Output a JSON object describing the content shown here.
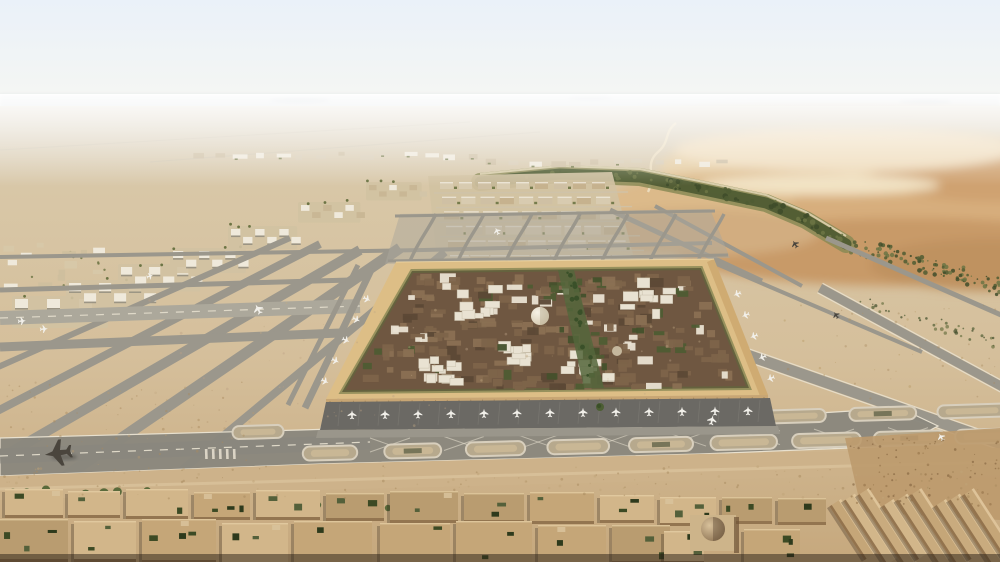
{
  "palette": {
    "skyTop": "#eaf1f9",
    "skyLow": "#f7f7f2",
    "hazeRidge": "#b7c2cb",
    "hillBlue": "#a9b5bf",
    "farDesert": "#ddd6c7",
    "sand": "#d6c19e",
    "sandLow": "#c6a87d",
    "duneLight": "#e6cfa6",
    "duneMid": "#d7ae7d",
    "duneDark": "#c2976a",
    "duneDeep": "#bf9261",
    "vegDark": "#4f5c33",
    "vegMid": "#6c7444",
    "vegLight": "#8a8a55",
    "trackLight": "#ecdfc2",
    "runway": "#9b978c",
    "runwayLight": "#aca89b",
    "apron": "#8b887e",
    "apronDark": "#6b6964",
    "marking": "#e9e2d1",
    "padFill": "#b7a98d",
    "padStroke": "#d8cfbd",
    "padInner": "#c9b795",
    "terminalFrame": "#ddbe86",
    "terminalFrameShadow": "#c69f66",
    "terminalField": "#6f5741",
    "blockBrown1": "#7d644a",
    "blockBrown2": "#8a7053",
    "blockBrown3": "#5c4936",
    "blockWhite": "#e9e2d2",
    "blockGreen": "#4e5c33",
    "domeLight": "#f6f1e5",
    "domeShade": "#c9bda2",
    "roofTan": "#c5a678",
    "roofTanLight": "#d2b68a",
    "roofShadow": "#6e5236",
    "courtGreen": "#3c4a24",
    "treeGreen": "#5a6a3b",
    "barShadow": "#8a6a45",
    "barLight": "#e0c79c",
    "planeWhite": "#f2f0ea",
    "planeDark": "#4a453d",
    "groundShadow": "#2a1f15",
    "districtSand": "#d2c2a2",
    "districtWhite": "#efe9db",
    "roughSand": "#bd9a6d",
    "serviceRoad": "#9a968b",
    "facade": "#c8a674"
  },
  "scene": {
    "seed": 7,
    "horizon_hills": [
      [
        300,
        100,
        30,
        3
      ],
      [
        590,
        98,
        22,
        2.5
      ],
      [
        925,
        102,
        26,
        3
      ]
    ],
    "terminal": {
      "outer": [
        [
          396,
          262
        ],
        [
          714,
          259
        ],
        [
          768,
          395
        ],
        [
          326,
          399
        ]
      ],
      "inner": [
        [
          412,
          271
        ],
        [
          701,
          268
        ],
        [
          749,
          388
        ],
        [
          342,
          392
        ]
      ],
      "mosaic_count": 250,
      "white_cluster_count": 52,
      "green_patch_count": 28,
      "spine_tree_count": 18,
      "facade_column_count": 38,
      "dome": {
        "x": 540,
        "y": 316,
        "r": 9
      },
      "dome2": {
        "x": 617,
        "y": 351,
        "r": 5
      },
      "white_zones": [
        [
          468,
          298,
          26
        ],
        [
          648,
          292,
          30
        ],
        [
          586,
          364,
          26
        ],
        [
          432,
          368,
          22
        ],
        [
          508,
          350,
          16
        ]
      ],
      "docked_left_count": 5,
      "docked_right_count": 5
    },
    "gate_apron": {
      "aircraft_count": 13,
      "tree": {
        "x": 600,
        "y": 407
      }
    },
    "pad_rows": [
      {
        "x0": 258,
        "y0": 432,
        "x1": 972,
        "y1": 411,
        "count": 9,
        "w": 60,
        "h": 13
      },
      {
        "x0": 330,
        "y0": 453,
        "x1": 992,
        "y1": 436,
        "count": 9,
        "w": 64,
        "h": 14
      }
    ],
    "districts": {
      "grid_rows": 7,
      "grid_cols": 9,
      "cluster_count": 7,
      "canopy_count": 5,
      "town_block_count": 16,
      "top_strip_count": 26
    },
    "foreground": {
      "bar_count": 9,
      "dome": {
        "x": 713,
        "y": 533,
        "r": 12
      },
      "tree_cluster_count": 10
    },
    "speckles": {
      "foreground": 130,
      "left_desert": 70,
      "bottom_right": 90,
      "midfield": 60,
      "right_sand": 50,
      "belt_shrubs": 90,
      "lower_shrubs": 40
    },
    "aircraft": [
      {
        "x": 58,
        "y": 453,
        "rot": -98,
        "s": 2.4,
        "tone": "dark"
      },
      {
        "x": 258,
        "y": 309,
        "rot": -28,
        "s": 0.9,
        "tone": "white"
      },
      {
        "x": 497,
        "y": 231,
        "rot": -25,
        "s": 0.65,
        "tone": "white"
      },
      {
        "x": 795,
        "y": 244,
        "rot": -32,
        "s": 0.7,
        "tone": "dark"
      },
      {
        "x": 836,
        "y": 315,
        "rot": -35,
        "s": 0.65,
        "tone": "dark"
      },
      {
        "x": 712,
        "y": 420,
        "rot": 12,
        "s": 0.85,
        "tone": "white"
      },
      {
        "x": 941,
        "y": 437,
        "rot": -30,
        "s": 0.7,
        "tone": "white"
      },
      {
        "x": 22,
        "y": 321,
        "rot": 85,
        "s": 0.7,
        "tone": "white"
      },
      {
        "x": 44,
        "y": 329,
        "rot": 85,
        "s": 0.7,
        "tone": "white"
      },
      {
        "x": 150,
        "y": 276,
        "rot": 70,
        "s": 0.6,
        "tone": "white"
      }
    ]
  }
}
